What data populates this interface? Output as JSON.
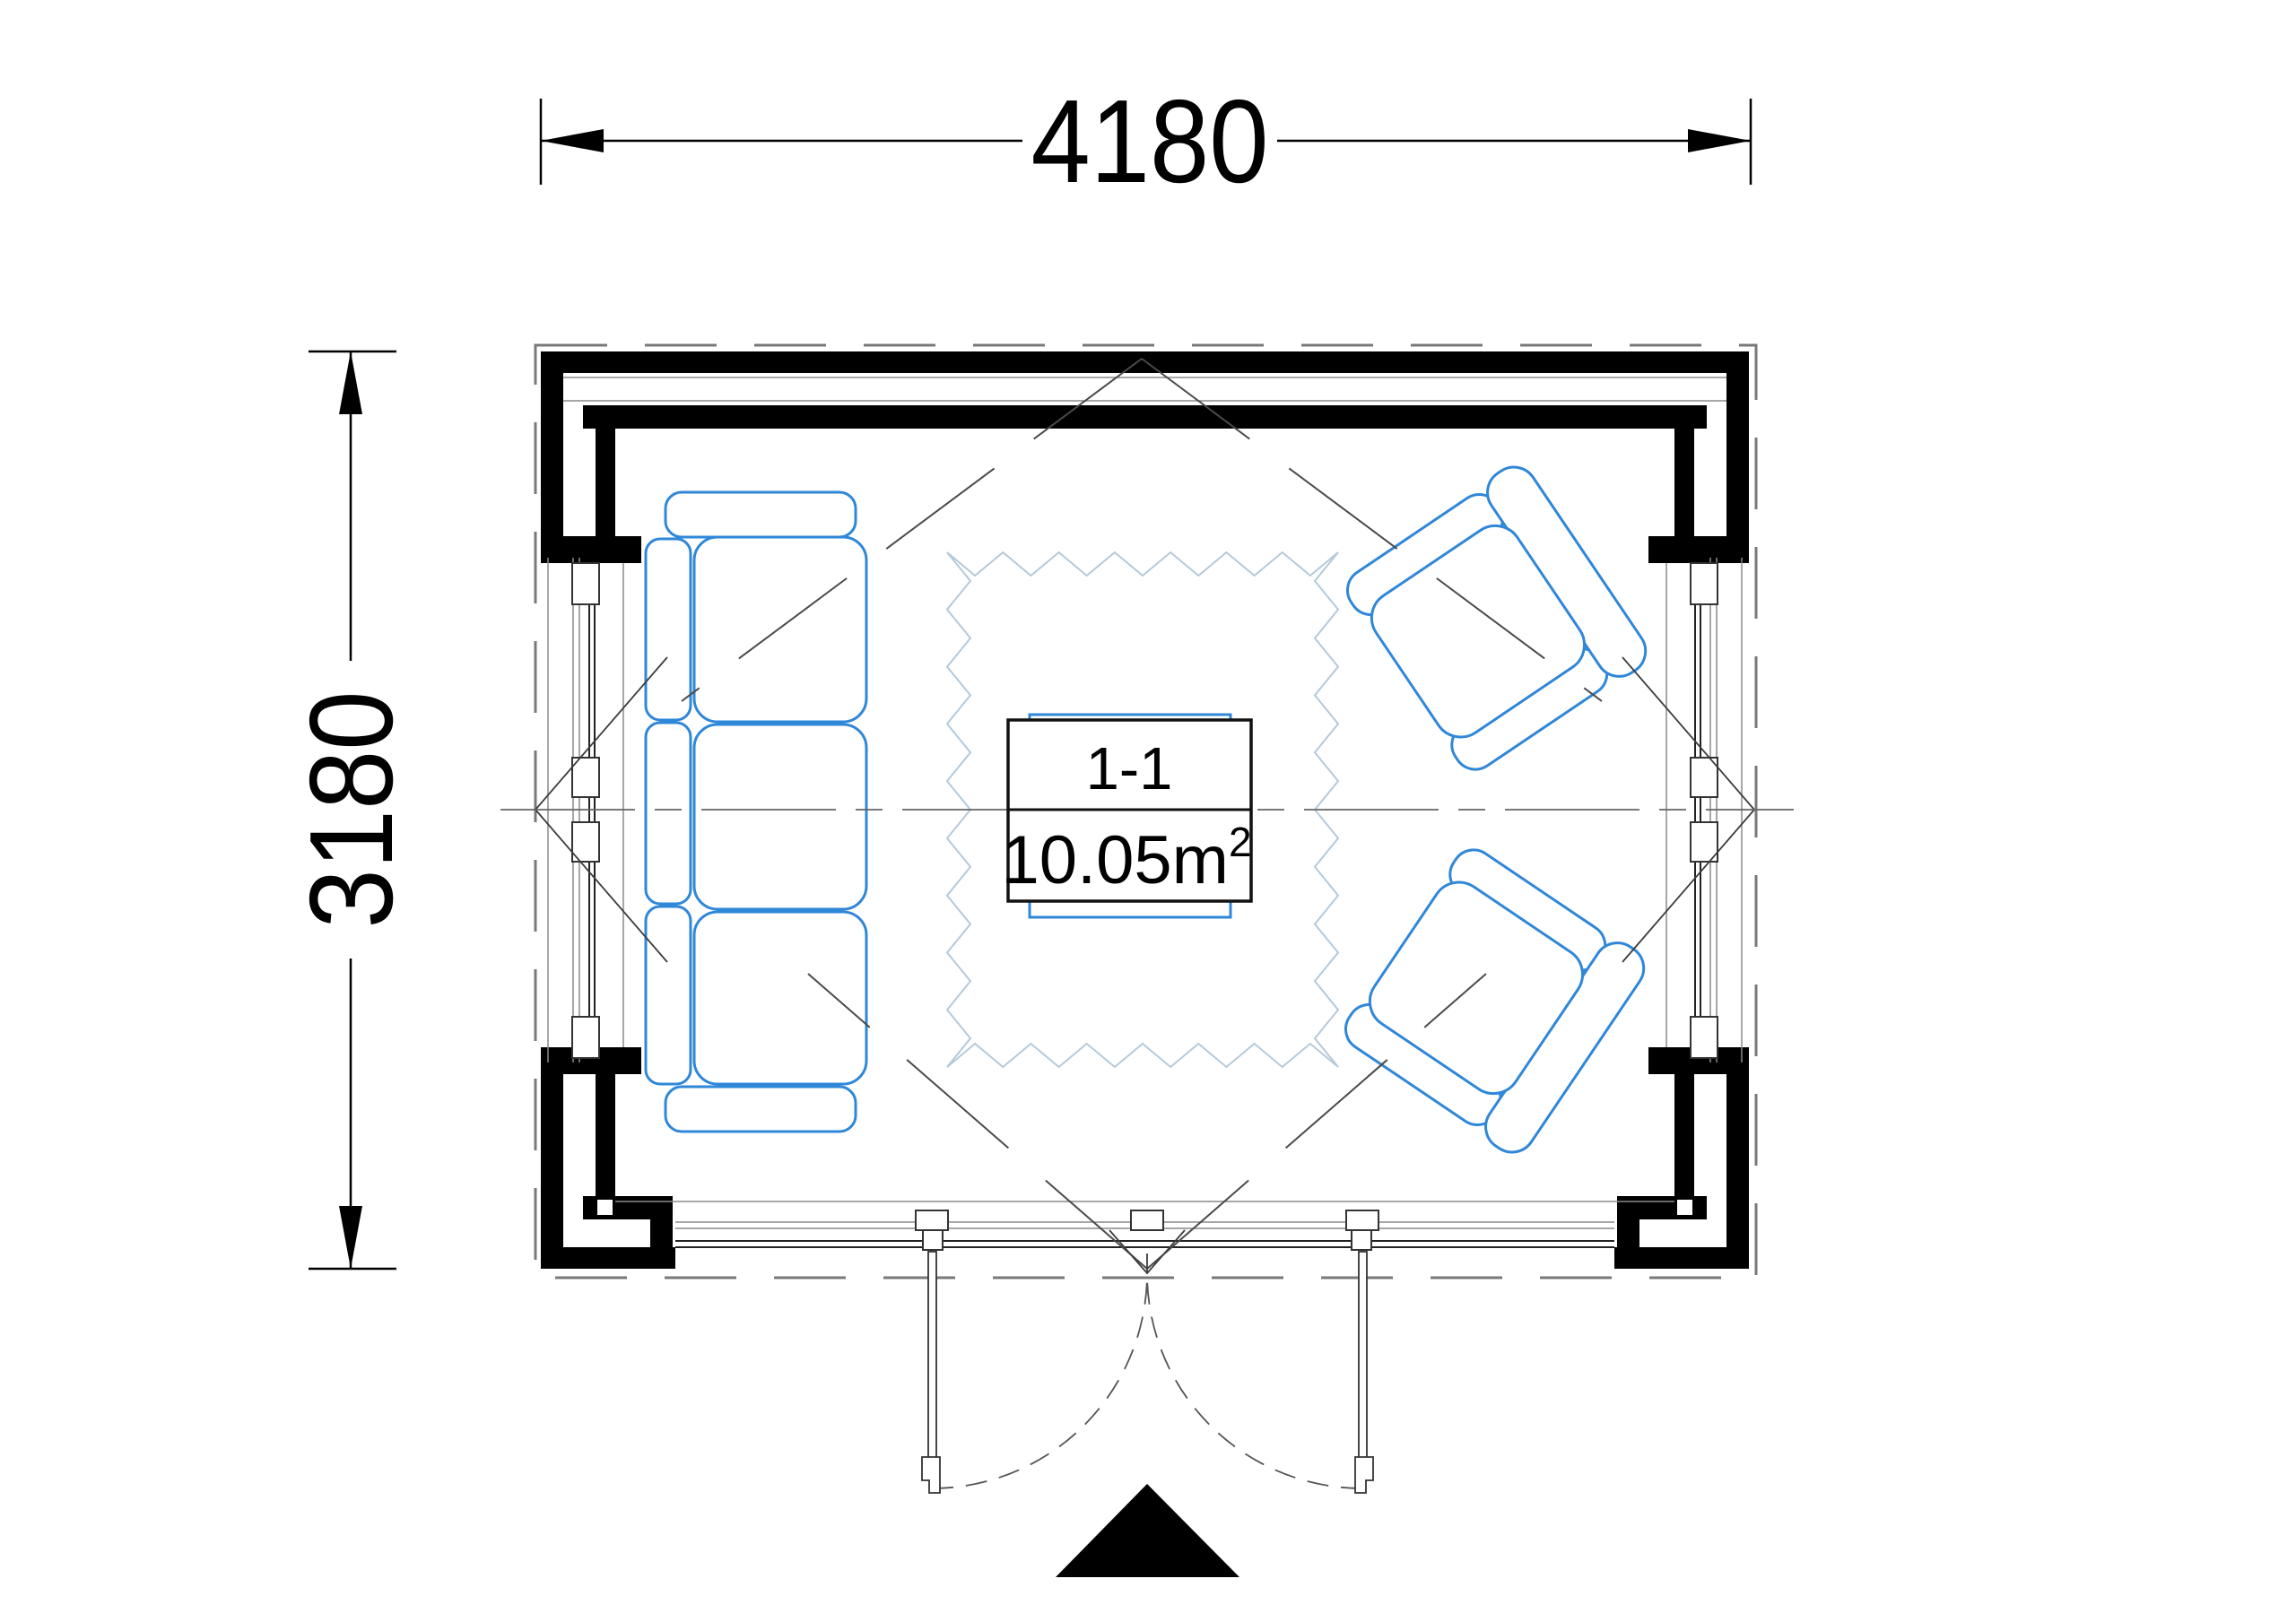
{
  "plan": {
    "type": "floor-plan",
    "room": {
      "name": "1-1",
      "area_base": "10.05m",
      "area_exponent": "2",
      "area_full": "10.05m²"
    },
    "dimensions": {
      "width_label": "4180",
      "height_label": "3180"
    },
    "colors": {
      "furniture": "#2f87d8",
      "rug": "#b4c9da",
      "walls": "#000000",
      "centerline": "#666666"
    },
    "furniture": {
      "sofa": "three-seat-sofa",
      "armchair_count": 2,
      "rug": "zigzag-rug",
      "table": "coffee-table"
    },
    "symbols": {
      "entrance_marker": "entrance-triangle",
      "doors": "double-outswing-doors"
    }
  }
}
